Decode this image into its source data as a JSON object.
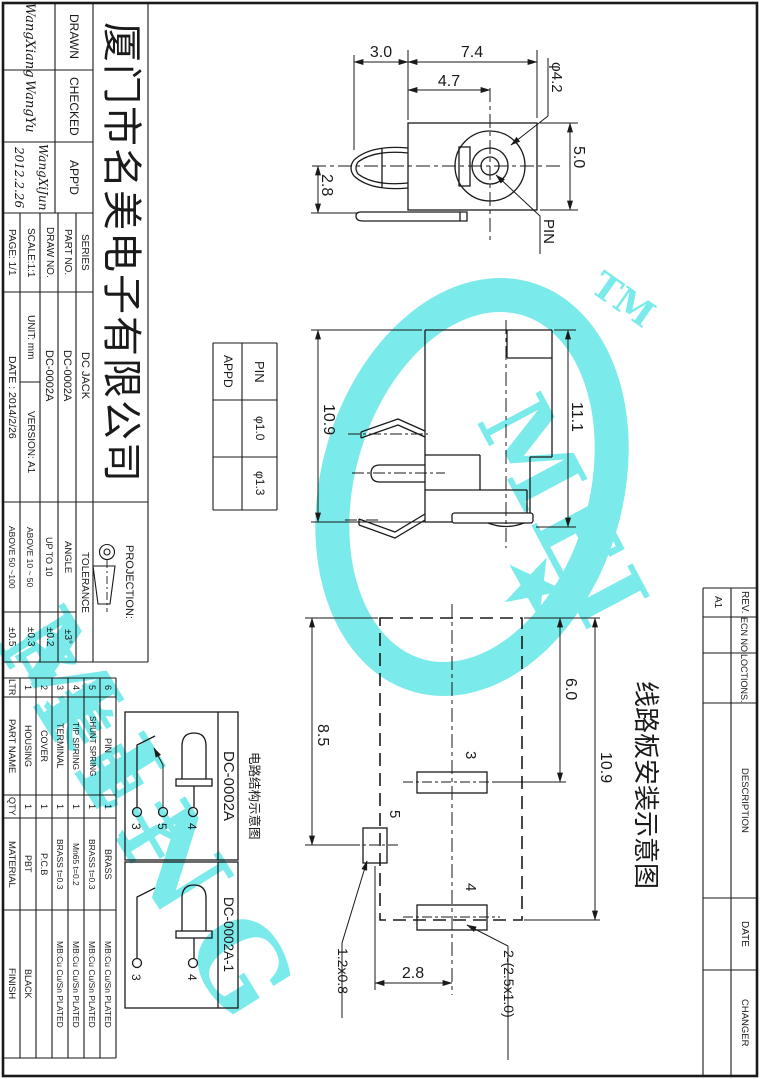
{
  "title_block": {
    "company": "厦门市名美电子有限公司",
    "drawn_label": "DRAWN",
    "drawn_sign": "WangXiang",
    "checked_label": "CHECKED",
    "checked_sign": "WangYu",
    "appd_label": "APP'D",
    "appd_sign": "WangXiJun",
    "appd_sign_date": "2012.2.26",
    "series_label": "SERIES",
    "series_value": "DC JACK",
    "part_no_label": "PART NO.",
    "part_no_value": "DC-0002A",
    "draw_no_label": "DRAW NO.",
    "draw_no_value": "DC-0002A",
    "scale_label": "SCALE:1:1",
    "unit_label": "UNIT: mm",
    "version_label": "VERSION: A1",
    "page_label": "PAGE: 1/1",
    "date_label": "DATE : 2014/2/26",
    "projection_label": "PROJECTION:",
    "tolerance_label": "TOLERANCE",
    "tolerance_rows": [
      {
        "range": "ANGLE",
        "value": "±3°"
      },
      {
        "range": "UP TO 10",
        "value": "±0.2"
      },
      {
        "range": "ABOVE 10 ~ 50",
        "value": "±0.3"
      },
      {
        "range": "ABOVE 50 ~100",
        "value": "±0.5"
      }
    ]
  },
  "parts_table": {
    "headers": {
      "ltr": "LTR",
      "part_name": "PART NAME",
      "qty": "QTY",
      "material": "MATERIAL",
      "finish": "FINISH"
    },
    "rows": [
      {
        "ltr": "1",
        "part_name": "HOUSING",
        "qty": "1",
        "material": "PBT",
        "finish": "BLACK"
      },
      {
        "ltr": "2",
        "part_name": "COVER",
        "qty": "1",
        "material": "P.C.B",
        "finish": ""
      },
      {
        "ltr": "3",
        "part_name": "TERMINAL",
        "qty": "1",
        "material": "BRASS t=0.3",
        "finish": "MB:Cu Cu/Sn PLATED"
      },
      {
        "ltr": "4",
        "part_name": "TIP SPRING",
        "qty": "1",
        "material": "Mn65 t=0.2",
        "finish": "MB:Cu Cu/Sn PLATED"
      },
      {
        "ltr": "5",
        "part_name": "SHUNT SPRING",
        "qty": "1",
        "material": "BRASS t=0.3",
        "finish": "MB:Cu Cu/Sn PLATED"
      },
      {
        "ltr": "6",
        "part_name": "PIN",
        "qty": "1",
        "material": "BRASS",
        "finish": "MB:Cu Cu/Sn PLATED"
      }
    ]
  },
  "revision_block": {
    "rev_label": "REV.",
    "rev_value": "A1",
    "ecn_label": "ECN NO.",
    "locations_label": "LOCTIONS.",
    "description_label": "DESCRIPTION",
    "date_label": "DATE",
    "changer_label": "CHANGER"
  },
  "pin_table": {
    "pin_label": "PIN",
    "appd_label": "APPD",
    "option_1": "φ1.0",
    "option_2": "φ1.3"
  },
  "views": {
    "front": {
      "dim_fork": "3.0",
      "dim_body": "7.4",
      "dim_center": "4.7",
      "dim_dia": "φ4.2",
      "dim_height": "5.0",
      "dim_below": "2.8",
      "pin_label": "PIN"
    },
    "side": {
      "dim_left": "10.9",
      "dim_right": "11.1"
    },
    "pcb": {
      "caption": "线路板安装示意图",
      "dim_left": "8.5",
      "dim_inner": "6.0",
      "dim_outer": "10.9",
      "dim_bottom": "2.8",
      "pad3": "3",
      "pad5": "5",
      "pad4": "4",
      "callout_pad5": "1.2x0.8",
      "callout_pads": "2-(2.5x1.0)"
    }
  },
  "circuit": {
    "caption": "电路结构示意图",
    "box1_label": "DC-0002A",
    "box2_label": "DC-0002A-1",
    "b1_pin3": "3",
    "b1_pin5": "5",
    "b1_pin4": "4",
    "b2_pin3": "3",
    "b2_pin4": "4"
  },
  "watermark": {
    "ming": "MING",
    "mei": "MEI",
    "tm": "TM",
    "cjk": "名美电子",
    "star": "★",
    "color": "#7AEAEA"
  }
}
